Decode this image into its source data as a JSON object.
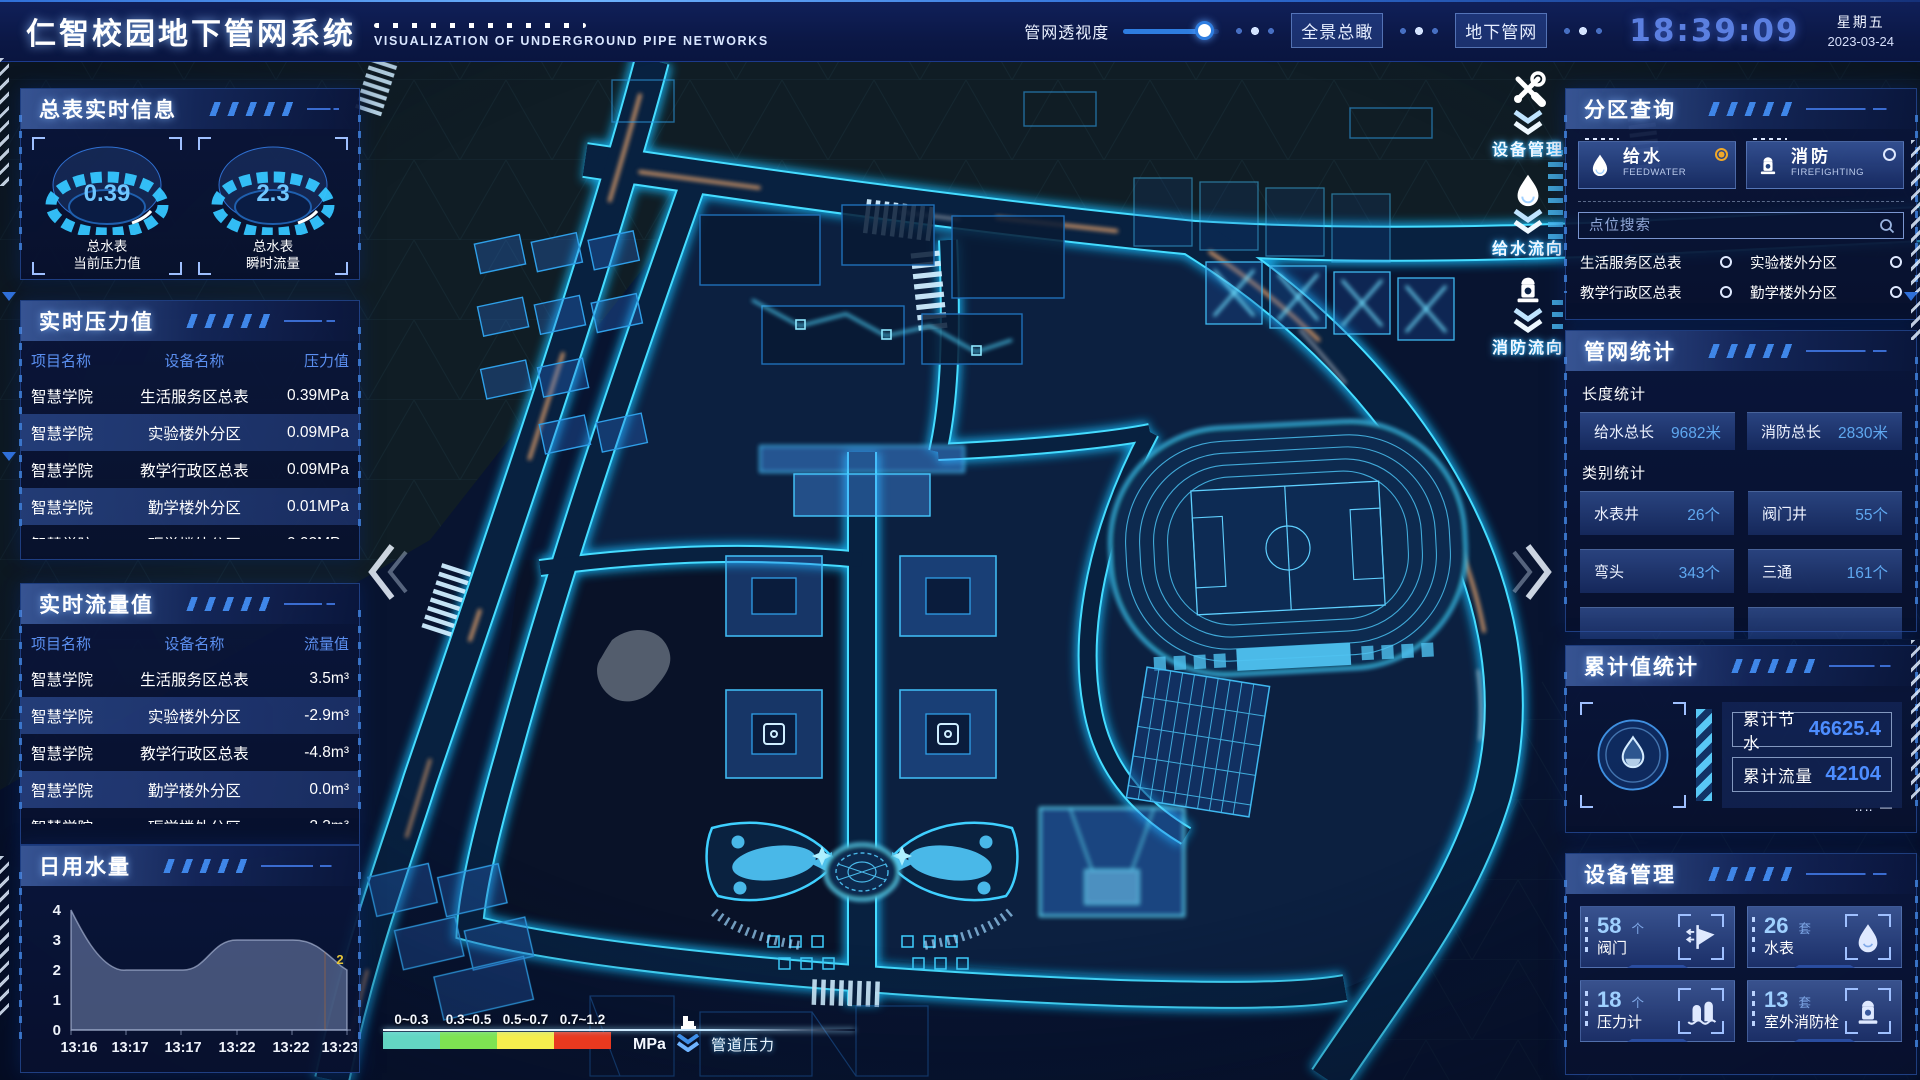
{
  "header": {
    "title": "仁智校园地下管网系统",
    "subtitle": "VISUALIZATION OF UNDERGROUND PIPE NETWORKS",
    "opacity_label": "管网透视度",
    "btn_overview": "全景总瞰",
    "btn_underground": "地下管网",
    "time": "18:39:09",
    "weekday": "星期五",
    "date": "2023-03-24"
  },
  "left": {
    "realtime_info": {
      "title": "总表实时信息",
      "gauges": [
        {
          "value": "0.39",
          "label1": "总水表",
          "label2": "当前压力值"
        },
        {
          "value": "2.3",
          "label1": "总水表",
          "label2": "瞬时流量"
        }
      ]
    },
    "pressure": {
      "title": "实时压力值",
      "headers": [
        "项目名称",
        "设备名称",
        "压力值"
      ],
      "rows": [
        [
          "智慧学院",
          "生活服务区总表",
          "0.39MPa"
        ],
        [
          "智慧学院",
          "实验楼外分区",
          "0.09MPa"
        ],
        [
          "智慧学院",
          "教学行政区总表",
          "0.09MPa"
        ],
        [
          "智慧学院",
          "勤学楼外分区",
          "0.01MPa"
        ],
        [
          "智慧学院",
          "砺学楼外分区",
          "0.02MPa"
        ]
      ]
    },
    "flow": {
      "title": "实时流量值",
      "headers": [
        "项目名称",
        "设备名称",
        "流量值"
      ],
      "rows": [
        [
          "智慧学院",
          "生活服务区总表",
          "3.5m³"
        ],
        [
          "智慧学院",
          "实验楼外分区",
          "-2.9m³"
        ],
        [
          "智慧学院",
          "教学行政区总表",
          "-4.8m³"
        ],
        [
          "智慧学院",
          "勤学楼外分区",
          "0.0m³"
        ],
        [
          "智慧学院",
          "砺学楼外分区",
          "2.3m³"
        ]
      ]
    },
    "daily_water": {
      "title": "日用水量",
      "chart_data": {
        "type": "area",
        "x": [
          "13:16",
          "13:17",
          "13:17",
          "13:22",
          "13:22",
          "13:23"
        ],
        "values": [
          4,
          2,
          2,
          3,
          3,
          2
        ],
        "yticks": [
          0,
          1,
          2,
          3,
          4
        ],
        "ylim": [
          0,
          4
        ],
        "end_label": "2"
      }
    }
  },
  "right": {
    "zone_query": {
      "title": "分区查询",
      "tabs": [
        {
          "label": "给水",
          "sub": "FEEDWATER",
          "active": true
        },
        {
          "label": "消防",
          "sub": "FIREFIGHTING",
          "active": false
        }
      ],
      "search_placeholder": "点位搜索",
      "items": [
        "生活服务区总表",
        "实验楼外分区",
        "教学行政区总表",
        "勤学楼外分区",
        "砺学楼外分区",
        "宿舍区泵房"
      ]
    },
    "pipe_stats": {
      "title": "管网统计",
      "length_title": "长度统计",
      "length_stats": [
        {
          "label": "给水总长",
          "value": "9682米"
        },
        {
          "label": "消防总长",
          "value": "2830米"
        }
      ],
      "category_title": "类别统计",
      "category_stats": [
        {
          "label": "水表井",
          "value": "26个"
        },
        {
          "label": "阀门井",
          "value": "55个"
        },
        {
          "label": "弯头",
          "value": "343个"
        },
        {
          "label": "三通",
          "value": "161个"
        }
      ]
    },
    "cumulative": {
      "title": "累计值统计",
      "icon": "water-drop-icon",
      "stats": [
        {
          "label": "累计节水",
          "value": "46625.4"
        },
        {
          "label": "累计流量",
          "value": "42104"
        }
      ]
    },
    "devices": {
      "title": "设备管理",
      "cards": [
        {
          "count": "58",
          "unit": "个",
          "label": "阀门",
          "icon": "valve-icon"
        },
        {
          "count": "26",
          "unit": "套",
          "label": "水表",
          "icon": "water-meter-icon"
        },
        {
          "count": "18",
          "unit": "个",
          "label": "压力计",
          "icon": "pressure-gauge-icon"
        },
        {
          "count": "13",
          "unit": "套",
          "label": "室外消防栓",
          "icon": "hydrant-icon"
        }
      ]
    }
  },
  "map": {
    "controls": [
      {
        "label": "设备管理",
        "icon": "tools-icon"
      },
      {
        "label": "给水流向",
        "icon": "water-drop-icon"
      },
      {
        "label": "消防流向",
        "icon": "hydrant-icon"
      }
    ],
    "legend": {
      "ranges": [
        "0~0.3",
        "0.3~0.5",
        "0.5~0.7",
        "0.7~1.2"
      ],
      "colors": [
        "#63d6c3",
        "#7ee352",
        "#f5ee4e",
        "#e8391f"
      ],
      "unit": "MPa",
      "label": "管道压力",
      "icon": "pressure-meter-icon"
    }
  },
  "colors": {
    "accent_cyan": "#2fd8ff",
    "accent_blue": "#3f7fd8",
    "time_blue": "#5b7fe0",
    "value_blue": "#4d8dff",
    "active_radio_orange": "#f0a828",
    "chart_end_label_yellow": "#e6c53a"
  }
}
